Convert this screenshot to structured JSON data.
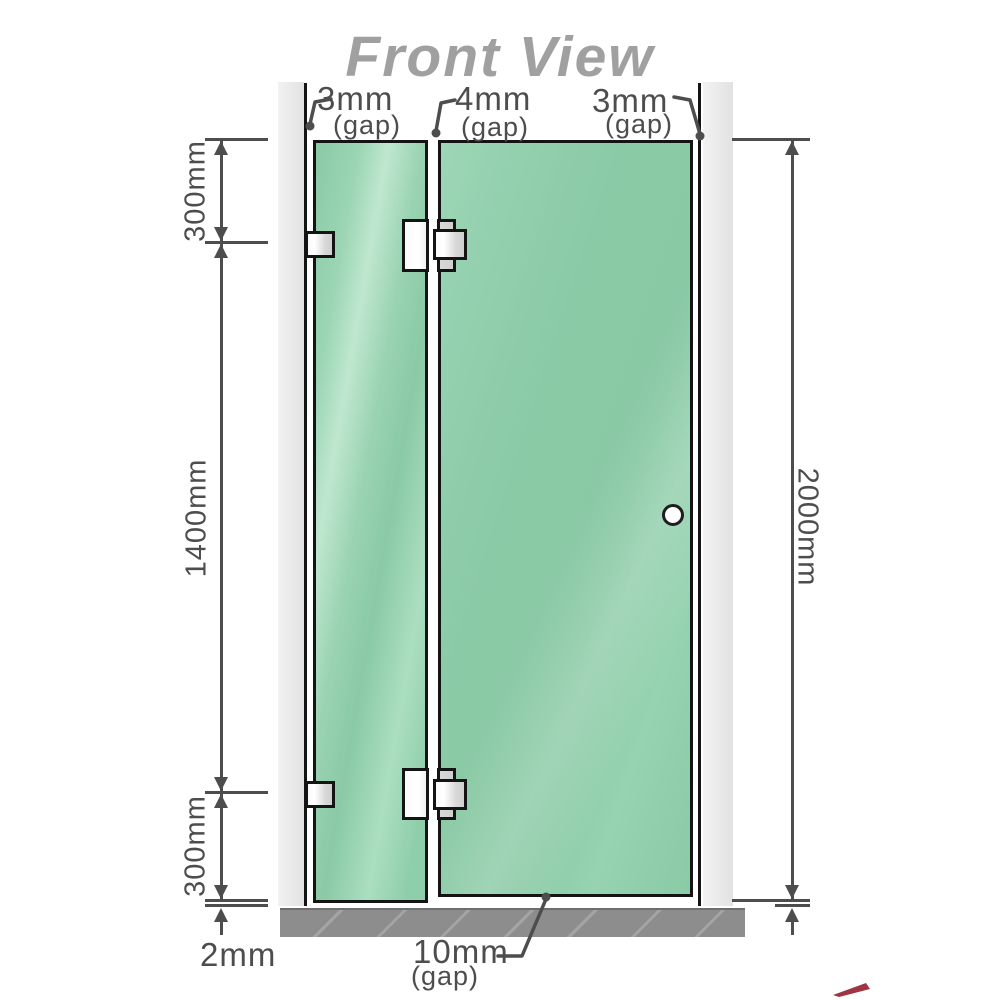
{
  "title": "Front View",
  "gap_labels": {
    "top_left": {
      "value": "3mm",
      "caption": "(gap)"
    },
    "top_middle": {
      "value": "4mm",
      "caption": "(gap)"
    },
    "top_right": {
      "value": "3mm",
      "caption": "(gap)"
    },
    "bottom": {
      "value": "10mm",
      "caption": "(gap)"
    }
  },
  "dimensions": {
    "upper_left_height": "300mm",
    "middle_left_height": "1400mm",
    "lower_left_height": "300mm",
    "right_overall_height": "2000mm",
    "floor_gap": "2mm"
  },
  "colors": {
    "glass": "#8ecbaa",
    "wall": "#ececec",
    "floor": "#8d8d8d",
    "dimension": "#4d4d4d",
    "title": "#a0a0a0",
    "outline": "#141414",
    "hardware": "#e8e8e8",
    "watermark_red": "#8e1022"
  }
}
